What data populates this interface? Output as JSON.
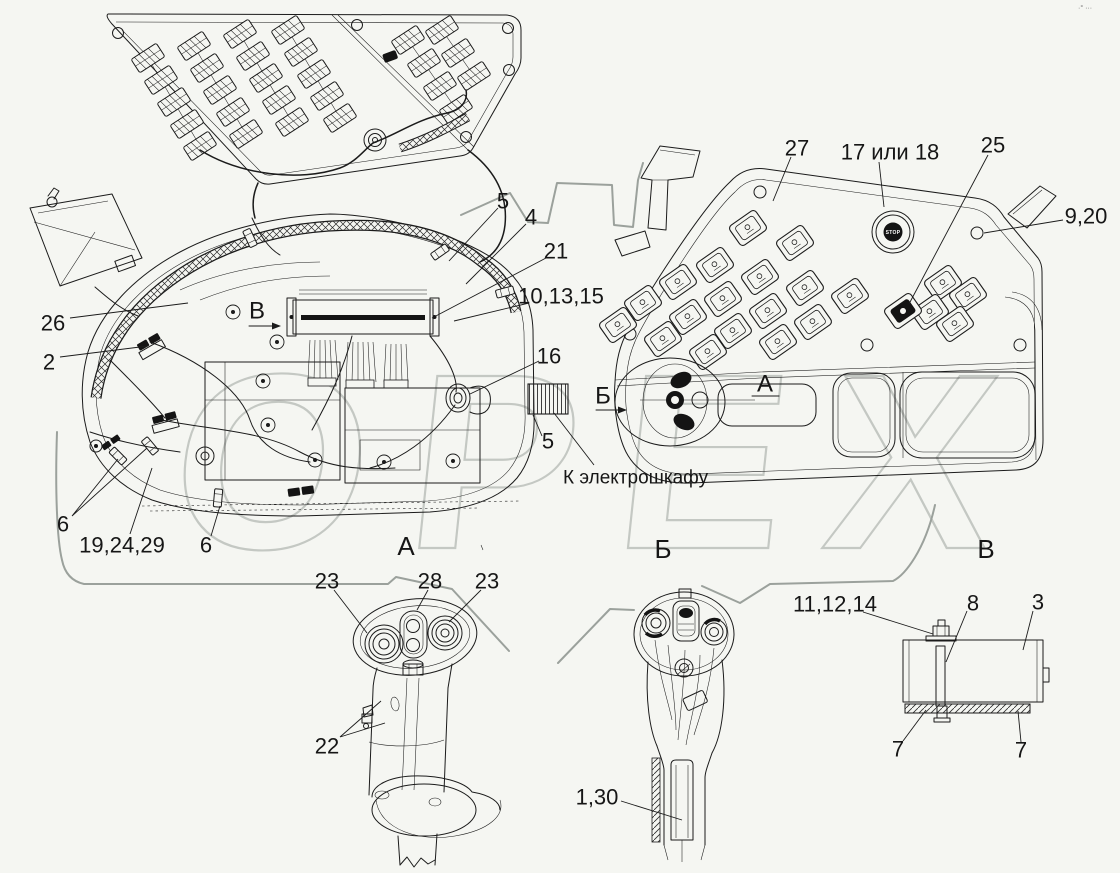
{
  "figure": {
    "background": "#f5f6f2",
    "line_color": "#1b1b1b",
    "watermark_text": "ОРЕХ",
    "corner_mark": "·° ···",
    "stop_button_label": "STOP"
  },
  "view_labels": {
    "a": "А",
    "b": "Б",
    "v": "В"
  },
  "direction_marks": {
    "view_v_arrow": "В",
    "view_b_arrow": "Б",
    "position_a": "А"
  },
  "callouts": {
    "n26": "26",
    "n2": "2",
    "n6_left": "6",
    "n19_24_29": "19,24,29",
    "n6_bottom": "6",
    "n5_top": "5",
    "n4": "4",
    "n21": "21",
    "n10_13_15": "10,13,15",
    "n16": "16",
    "n5_mid": "5",
    "to_cabinet": "К электрошкафу",
    "n27": "27",
    "n17_or_18": "17 или 18",
    "n25": "25",
    "n9_20": "9,20",
    "n23_left": "23",
    "n28": "28",
    "n23_right": "23",
    "n22": "22",
    "n1_30": "1,30",
    "n11_12_14": "11,12,14",
    "n8": "8",
    "n3": "3",
    "n7_left": "7",
    "n7_right": "7"
  }
}
